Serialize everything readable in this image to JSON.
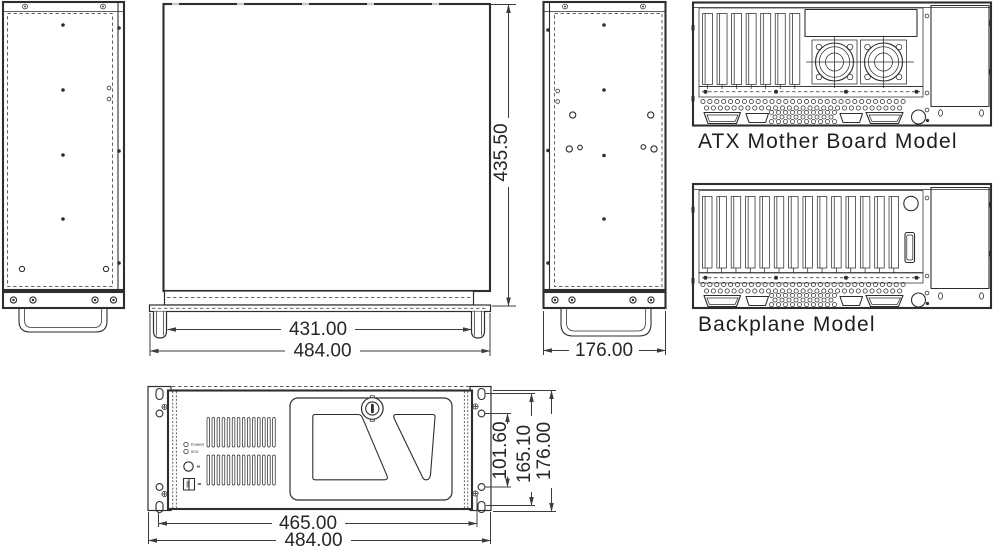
{
  "views": {
    "top": {
      "dim_height": "435.50",
      "dim_inner_width": "431.00",
      "dim_outer_width": "484.00"
    },
    "side": {
      "dim_depth": "176.00"
    },
    "atx_rear": {
      "label": "ATX Mother Board Model"
    },
    "backplane_rear": {
      "label": "Backplane Model"
    },
    "front": {
      "dim_window_height": "101.60",
      "dim_ear_height": "165.10",
      "dim_total_height": "176.00",
      "dim_inner_width": "465.00",
      "dim_outer_width": "484.00",
      "led_power": "POWER",
      "led_hdd": "HDD"
    }
  },
  "colors": {
    "line": "#2e2e2e",
    "dim_text": "#262626",
    "background": "#ffffff"
  }
}
